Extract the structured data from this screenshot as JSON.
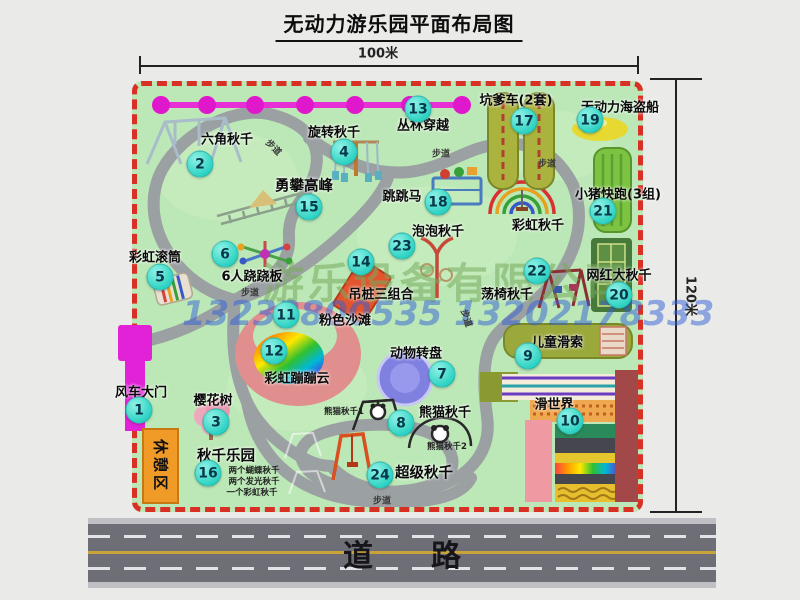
{
  "title": "无动力游乐园平面布局图",
  "dimensions": {
    "width": "100米",
    "height": "120米"
  },
  "road": {
    "label": "道路"
  },
  "watermarks": {
    "company": "游乐设备有限公司",
    "phone": "13233800535 13202178333"
  },
  "map": {
    "walkway_label": "步道",
    "rest_area_label": "休憩区",
    "rainbow_swing_label": "彩虹秋千",
    "panda_swing_1": "熊猫秋千1",
    "panda_swing_2": "熊猫秋千2",
    "swing_park_notes": [
      "两个蝴蝶秋千",
      "两个发光秋千",
      "一个彩虹秋千"
    ],
    "markers": [
      {
        "num": "1",
        "label": "风车大门"
      },
      {
        "num": "2",
        "label": "六角秋千"
      },
      {
        "num": "3",
        "label": "樱花树"
      },
      {
        "num": "4",
        "label": "旋转秋千"
      },
      {
        "num": "5",
        "label": "彩虹滚筒"
      },
      {
        "num": "6",
        "label": "6人跷跷板"
      },
      {
        "num": "7",
        "label": "动物转盘"
      },
      {
        "num": "8",
        "label": "熊猫秋千"
      },
      {
        "num": "9",
        "label": "儿童滑索"
      },
      {
        "num": "10",
        "label": "滑世界"
      },
      {
        "num": "11",
        "label": "粉色沙滩"
      },
      {
        "num": "12",
        "label": "彩虹蹦蹦云"
      },
      {
        "num": "13",
        "label": "丛林穿越"
      },
      {
        "num": "14",
        "label": "吊桩三组合"
      },
      {
        "num": "15",
        "label": "勇攀高峰"
      },
      {
        "num": "16",
        "label": "秋千乐园"
      },
      {
        "num": "17",
        "label": "坑爹车(2套)"
      },
      {
        "num": "18",
        "label": "跳跳马"
      },
      {
        "num": "19",
        "label": "无动力海盗船"
      },
      {
        "num": "20",
        "label": "网红大秋千"
      },
      {
        "num": "21",
        "label": "小猪快跑(3组)"
      },
      {
        "num": "22",
        "label": "荡椅秋千"
      },
      {
        "num": "23",
        "label": "泡泡秋千"
      },
      {
        "num": "24",
        "label": "超级秋千"
      }
    ],
    "colors": {
      "map_green": "#bce7b6",
      "border_red": "#d93025",
      "marker_cyan": "#2cd2c2",
      "zipline_magenta": "#e122d6",
      "rest_orange": "#f09a28",
      "path_gray": "#9ba0a2"
    }
  }
}
